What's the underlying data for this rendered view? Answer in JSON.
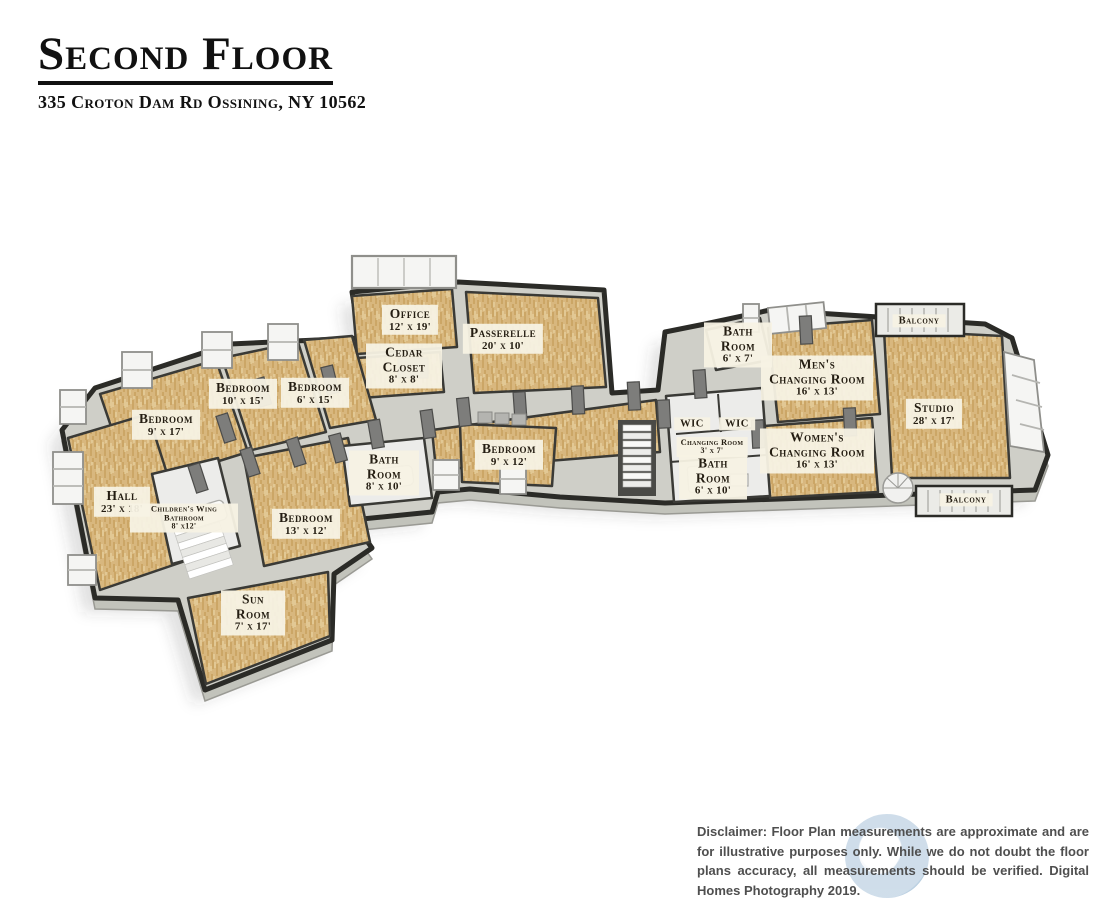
{
  "header": {
    "title": "Second Floor",
    "address": "335 Croton Dam Rd Ossining, NY 10562"
  },
  "rooms": [
    {
      "name": "Office",
      "dims": "12' x 19'"
    },
    {
      "name": "Passerelle",
      "dims": "20' x 10'"
    },
    {
      "name": "Cedar Closet",
      "dims": "8' x 8'"
    },
    {
      "name": "Bedroom",
      "dims": "9' x 17'"
    },
    {
      "name": "Bedroom",
      "dims": "10' x 15'"
    },
    {
      "name": "Bedroom",
      "dims": "6' x 15'"
    },
    {
      "name": "Hall",
      "dims": "23' x 18'"
    },
    {
      "name": "Children's Wing Bathroom",
      "dims": "8' x12'"
    },
    {
      "name": "Bedroom",
      "dims": "13' x 12'"
    },
    {
      "name": "Bath Room",
      "dims": "8' x 10'"
    },
    {
      "name": "Bedroom",
      "dims": "9' x 12'"
    },
    {
      "name": "Sun Room",
      "dims": "7' x 17'"
    },
    {
      "name": "Bath Room",
      "dims": "6' x 7'"
    },
    {
      "name": "Men's Changing Room",
      "dims": "16' x 13'"
    },
    {
      "name": "WIC"
    },
    {
      "name": "WIC"
    },
    {
      "name": "Changing Room",
      "dims": "3' x 7'"
    },
    {
      "name": "Bath Room",
      "dims": "6' x 10'"
    },
    {
      "name": "Women's Changing Room",
      "dims": "16' x 13'"
    },
    {
      "name": "Studio",
      "dims": "28' x 17'"
    },
    {
      "name": "Balcony"
    },
    {
      "name": "Balcony"
    }
  ],
  "footer": {
    "disclaimer": "Disclaimer: Floor Plan measurements are approximate and are for illustrative purposes only. While we do not doubt the floor plans accuracy, all measurements should be verified. Digital Homes Photography 2019."
  },
  "colors": {
    "wood_floor": "#d8b77e",
    "wood_grain_dark": "#c0964f",
    "wood_grain_light": "#eed9ab",
    "wall_light": "#cfcfc8",
    "wall_dark_cap": "#2b2b27",
    "tile_floor": "#ececea",
    "door_gray": "#7d7d7b",
    "label_bg": "#f7f2e4",
    "label_text": "#241d12",
    "disclaimer_text": "#4f4f4f",
    "watermark_blue": "#c7d8e7"
  }
}
